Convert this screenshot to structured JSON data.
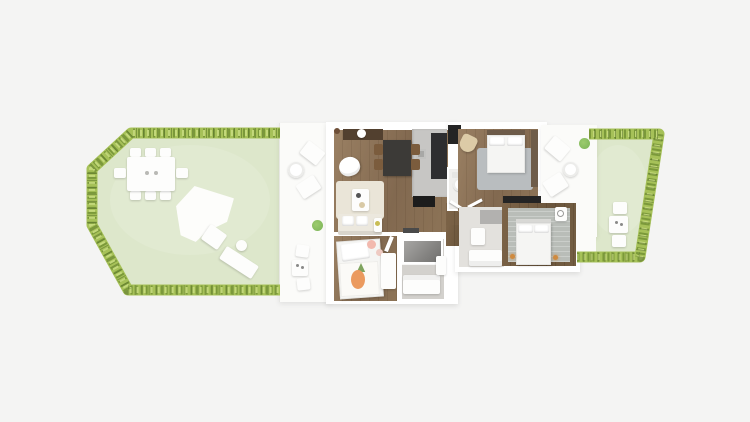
{
  "scene": {
    "kind": "3d-rendered-floor-plan",
    "view": "top-down",
    "gardens": [
      {
        "id": "garden-left",
        "side": "left",
        "border": "hedge",
        "furniture": [
          "outdoor-dining-table-with-eight-chairs",
          "lounge-daybed",
          "garden-bench",
          "pouf"
        ]
      },
      {
        "id": "garden-right",
        "side": "right",
        "border": "hedge",
        "furniture": [
          "bistro-table-with-two-chairs"
        ]
      }
    ],
    "terraces": [
      {
        "id": "terrace-left",
        "furniture": [
          "two-lounge-chairs",
          "round-side-table",
          "potted-plant",
          "bistro-set"
        ]
      },
      {
        "id": "terrace-right",
        "furniture": [
          "two-lounge-chairs",
          "round-side-table",
          "potted-plant"
        ]
      }
    ],
    "rooms": [
      {
        "id": "living-kitchen",
        "furniture": [
          "sideboard",
          "dining-table",
          "four-chairs",
          "armchair",
          "area-rug",
          "coffee-table",
          "sofa",
          "kitchen-counter",
          "tall-appliance-units",
          "sink",
          "dark-mat"
        ]
      },
      {
        "id": "wc",
        "furniture": [
          "toilet"
        ]
      },
      {
        "id": "bedroom-1",
        "furniture": [
          "double-bed",
          "area-rug",
          "accent-chair",
          "wardrobe"
        ]
      },
      {
        "id": "hallway",
        "furniture": [
          "interior-doors"
        ]
      },
      {
        "id": "kids-room",
        "furniture": [
          "single-bed-pineapple-blanket",
          "pink-poufs",
          "desk"
        ]
      },
      {
        "id": "bathroom",
        "furniture": [
          "walk-in-shower",
          "vanity-with-drawers",
          "side-cabinet"
        ]
      },
      {
        "id": "entry",
        "furniture": [
          "doormat",
          "cabinet",
          "wardrobe"
        ]
      },
      {
        "id": "bedroom-2",
        "furniture": [
          "double-bed",
          "bedside-lamps",
          "wall-shelf"
        ]
      }
    ]
  },
  "colors": {
    "bg": "#f4f4f3",
    "terrace": "#fbfbf9",
    "wall": "#ffffff",
    "grass": "#dde7cb",
    "hedge": "#a6c158",
    "hedge-dark": "#718f33",
    "hedge-deep": "#55702a",
    "hedge-light": "#c8dc80",
    "wood": "#96795a",
    "wood-dark": "#7c6448",
    "wood-deep": "#6b563d",
    "counter": "#c7c6c4",
    "appliance": "#2e2e30",
    "table-dark": "#3c3a37",
    "chair-wood": "#7b5c3d",
    "rug-cream": "#eae5d8",
    "sofa": "#ece8de",
    "rug-gray": "#b9bdbf",
    "tile": "#b9bdb8",
    "bath-floor": "#d3d1cd",
    "shower": "#7f7e7c",
    "wc-floor": "#f0efed",
    "entry-floor": "#e3e1dd",
    "mat": "#b2b1af",
    "bed-white": "#f5f5f3",
    "headboard": "#6d5b49",
    "wardrobe-wood": "#6e5c49",
    "pouf-pink": "#f2b9ae",
    "pineapple": "#eb9a5f",
    "leaf": "#7fa45f",
    "lamp": "#cf8a3f",
    "plant": "#7ab357",
    "beige-chair": "#dccba7",
    "dark-door": "#242424",
    "black-mat": "#1c1c1c",
    "accent-yellow": "#c9bd55"
  }
}
